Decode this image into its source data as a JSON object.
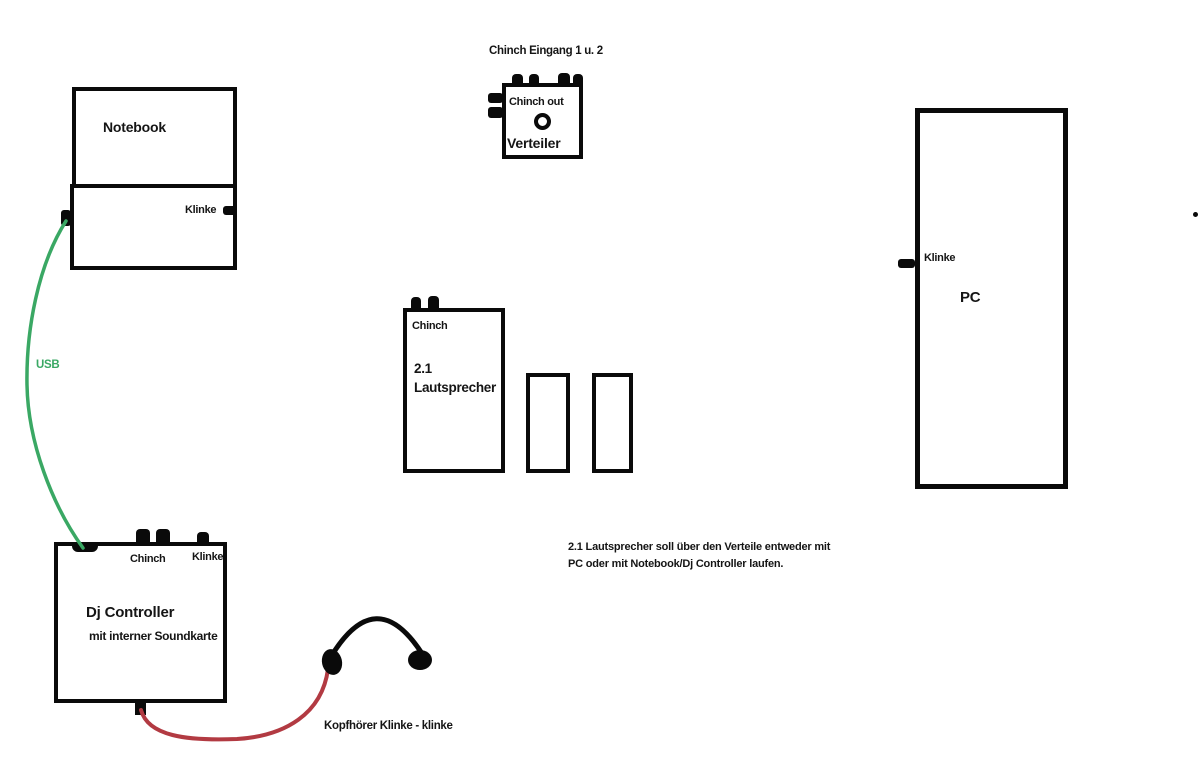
{
  "colors": {
    "ink": "#0a0a0a",
    "usb_cable": "#3aa864",
    "headphone_cable": "#b23a42"
  },
  "icons": {
    "port": "black-rectangle-connector",
    "knob": "circle-outline-knob",
    "headphones": "arc-headband-with-two-earcups",
    "stray_dot": "small-black-dot"
  },
  "nodes": {
    "notebook": {
      "label": "Notebook",
      "klinke_label": "Klinke"
    },
    "verteiler": {
      "caption_above": "Chinch Eingang 1 u. 2",
      "chinch_out_label": "Chinch out",
      "label": "Verteiler"
    },
    "pc": {
      "label": "PC",
      "klinke_label": "Klinke"
    },
    "speaker": {
      "chinch_label": "Chinch",
      "title_line1": "2.1",
      "title_line2": "Lautsprecher"
    },
    "dj_controller": {
      "label": "Dj Controller",
      "sublabel": "mit interner Soundkarte",
      "chinch_label": "Chinch",
      "klinke_label": "Klinke"
    }
  },
  "cables": {
    "usb_label": "USB",
    "headphone_label": "Kopfhörer Klinke - klinke"
  },
  "note": {
    "line1": "2.1 Lautsprecher soll über den Verteile entweder mit",
    "line2": "PC oder mit Notebook/Dj Controller laufen."
  }
}
